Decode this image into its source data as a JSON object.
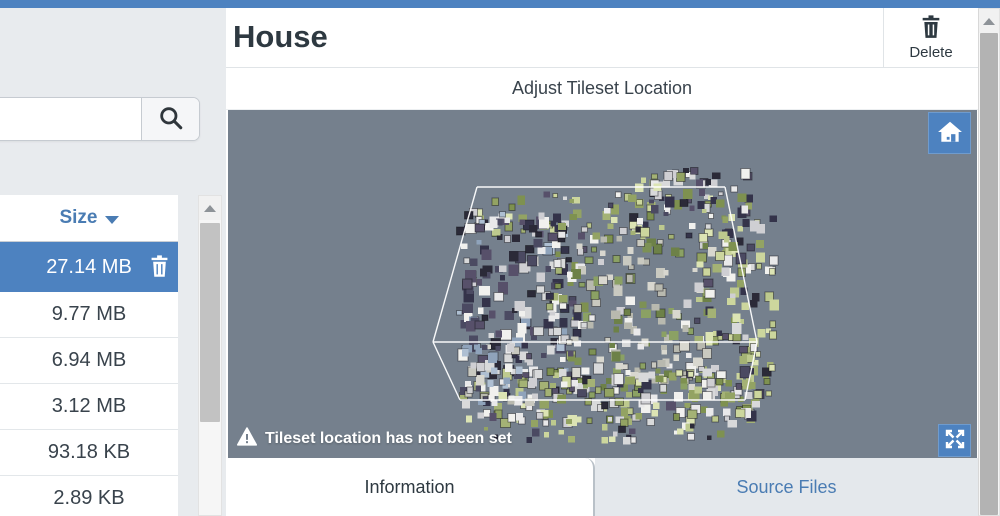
{
  "page": {
    "top_bar_color": "#4d82c0"
  },
  "sidebar": {
    "search": {
      "value": "",
      "placeholder": ""
    },
    "file_list": {
      "header": {
        "label": "Size",
        "sort_direction": "desc"
      },
      "rows": [
        {
          "size": "27.14 MB",
          "selected": true
        },
        {
          "size": "9.77 MB",
          "selected": false
        },
        {
          "size": "6.94 MB",
          "selected": false
        },
        {
          "size": "3.12 MB",
          "selected": false
        },
        {
          "size": "93.18 KB",
          "selected": false
        },
        {
          "size": "2.89 KB",
          "selected": false
        }
      ]
    }
  },
  "main": {
    "title": "House",
    "delete_button": {
      "label": "Delete"
    },
    "section_title": "Adjust Tileset Location",
    "viewer": {
      "warning_message": "Tileset location has not been set",
      "background_color": "#75808D",
      "wireframe_color": "#ffffff"
    },
    "tabs": [
      {
        "label": "Information",
        "active": true
      },
      {
        "label": "Source Files",
        "active": false
      }
    ]
  },
  "colors": {
    "accent_blue": "#4d82c0",
    "link_blue": "#4a7cb3",
    "dark_text": "#2e3941",
    "viewer_gray": "#75808D",
    "tab_inactive_bg": "#e4e8ec",
    "sidebar_bg": "#e8ebee"
  },
  "point_cloud": {
    "palette": {
      "darks": [
        "#34334a",
        "#2b2a38",
        "#4b4a62",
        "#57506a"
      ],
      "whites": [
        "#e9e9ea",
        "#d8d9da",
        "#f1f1ee",
        "#cfcfd3"
      ],
      "grays": [
        "#c9c9c0",
        "#d8d7cf",
        "#b8b9af"
      ],
      "moss": [
        "#7d9155",
        "#8ba164",
        "#6d8148"
      ],
      "lightGreens": [
        "#ccd69d",
        "#dce4b4",
        "#bdc98e"
      ],
      "midGreens": [
        "#93a363",
        "#7e9150",
        "#a4b275"
      ],
      "blues": [
        "#aebfd2",
        "#8fa3bb"
      ]
    }
  }
}
